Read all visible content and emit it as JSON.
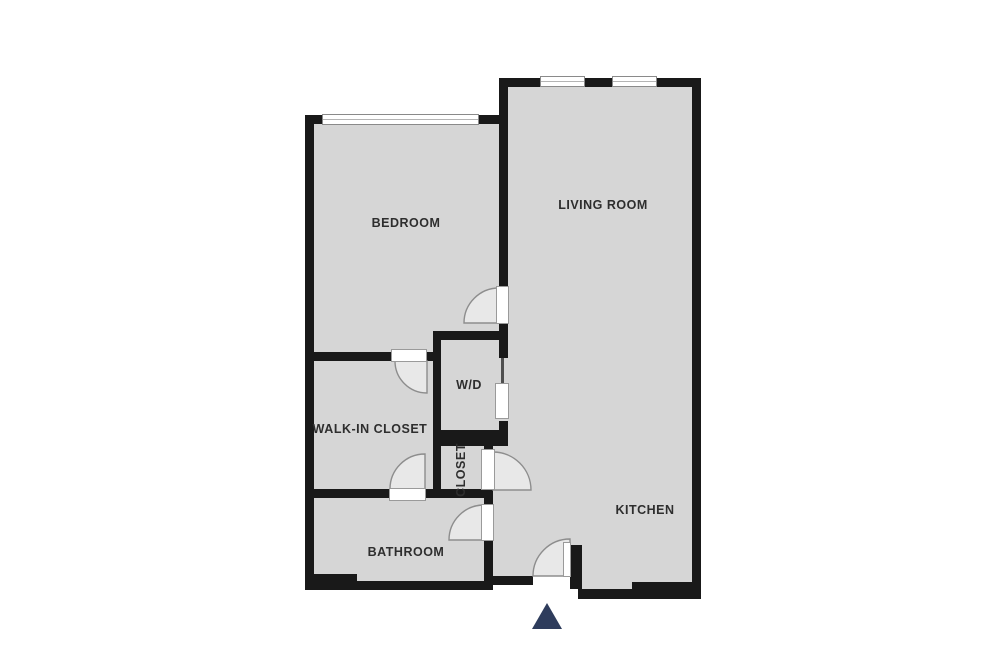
{
  "page": {
    "type": "floor-plan",
    "background": "#ffffff"
  },
  "plan": {
    "rooms": {
      "bedroom": {
        "label": "BEDROOM"
      },
      "living_room": {
        "label": "LIVING ROOM"
      },
      "wd": {
        "label": "W/D"
      },
      "walk_in_closet": {
        "label": "WALK-IN CLOSET"
      },
      "closet": {
        "label": "CLOSET"
      },
      "bathroom": {
        "label": "BATHROOM"
      },
      "kitchen": {
        "label": "KITCHEN"
      }
    },
    "icons": {
      "entrance_arrow": "triangle-up"
    },
    "colors": {
      "floor": "#d6d6d6",
      "wall": "#191919",
      "door_arc": "#8d8d8d",
      "door_leaf": "#ffffff",
      "window_border": "#8a8a8a",
      "entrance_arrow": "#2e3c5c",
      "label_text": "#2e2e2e"
    }
  }
}
